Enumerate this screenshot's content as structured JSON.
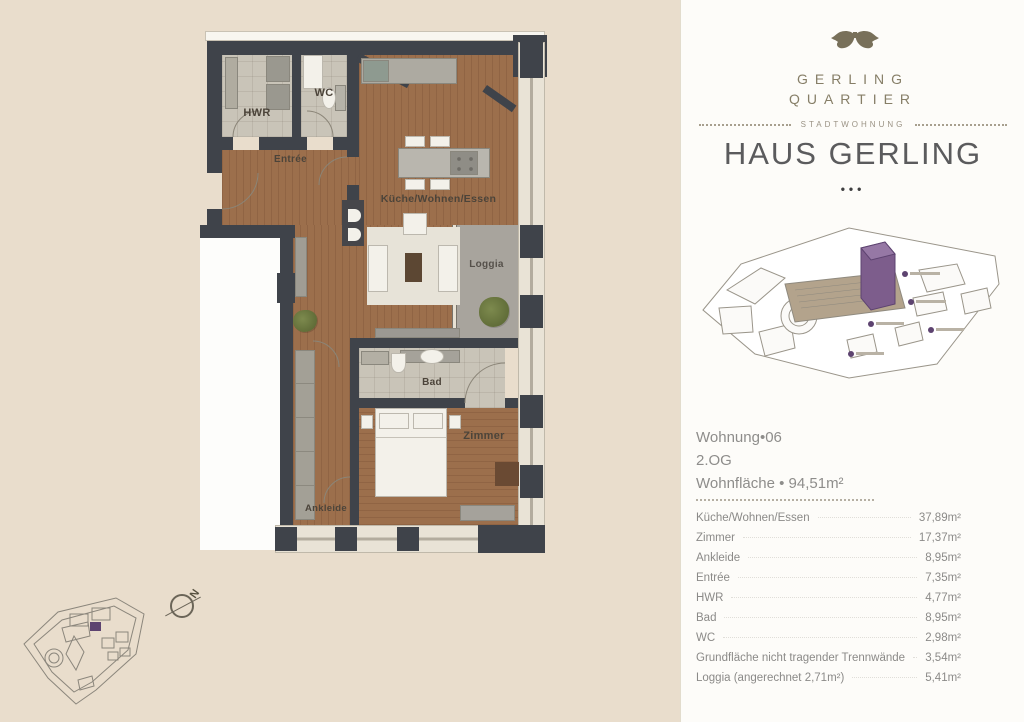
{
  "brand": {
    "line1": "GERLING",
    "line2": "QUARTIER",
    "tagline": "STADTWOHNUNG",
    "title": "HAUS GERLING",
    "separator_dots": "•••"
  },
  "apartment": {
    "unit": "Wohnung•06",
    "floor": "2.OG",
    "area": "Wohnfläche • 94,51m²"
  },
  "rooms_table": [
    {
      "label": "Küche/Wohnen/Essen",
      "value": "37,89m²"
    },
    {
      "label": "Zimmer",
      "value": "17,37m²"
    },
    {
      "label": "Ankleide",
      "value": "8,95m²"
    },
    {
      "label": "Entrée",
      "value": "7,35m²"
    },
    {
      "label": "HWR",
      "value": "4,77m²"
    },
    {
      "label": "Bad",
      "value": "8,95m²"
    },
    {
      "label": "WC",
      "value": "2,98m²"
    },
    {
      "label": "Grundfläche nicht tragender Trennwände",
      "value": "3,54m²"
    },
    {
      "label": "Loggia (angerechnet 2,71m²)",
      "value": "5,41m²"
    }
  ],
  "floorplan": {
    "labels": {
      "hwr": "HWR",
      "wc": "WC",
      "entree": "Entrée",
      "kitchen": "Küche/Wohnen/Essen",
      "loggia": "Loggia",
      "bad": "Bad",
      "zimmer": "Zimmer",
      "ankleide": "Ankleide"
    },
    "compass": "N"
  },
  "colors": {
    "page_bg": "#e9ddcc",
    "panel_bg": "#fdfcf9",
    "wall": "#3f434a",
    "wood_floor": "#9c6f4c",
    "tile_floor": "#c9c4b8",
    "loggia_floor": "#a8a49d",
    "highlight_purple": "#5d4370",
    "brand_olive": "#867e67"
  }
}
